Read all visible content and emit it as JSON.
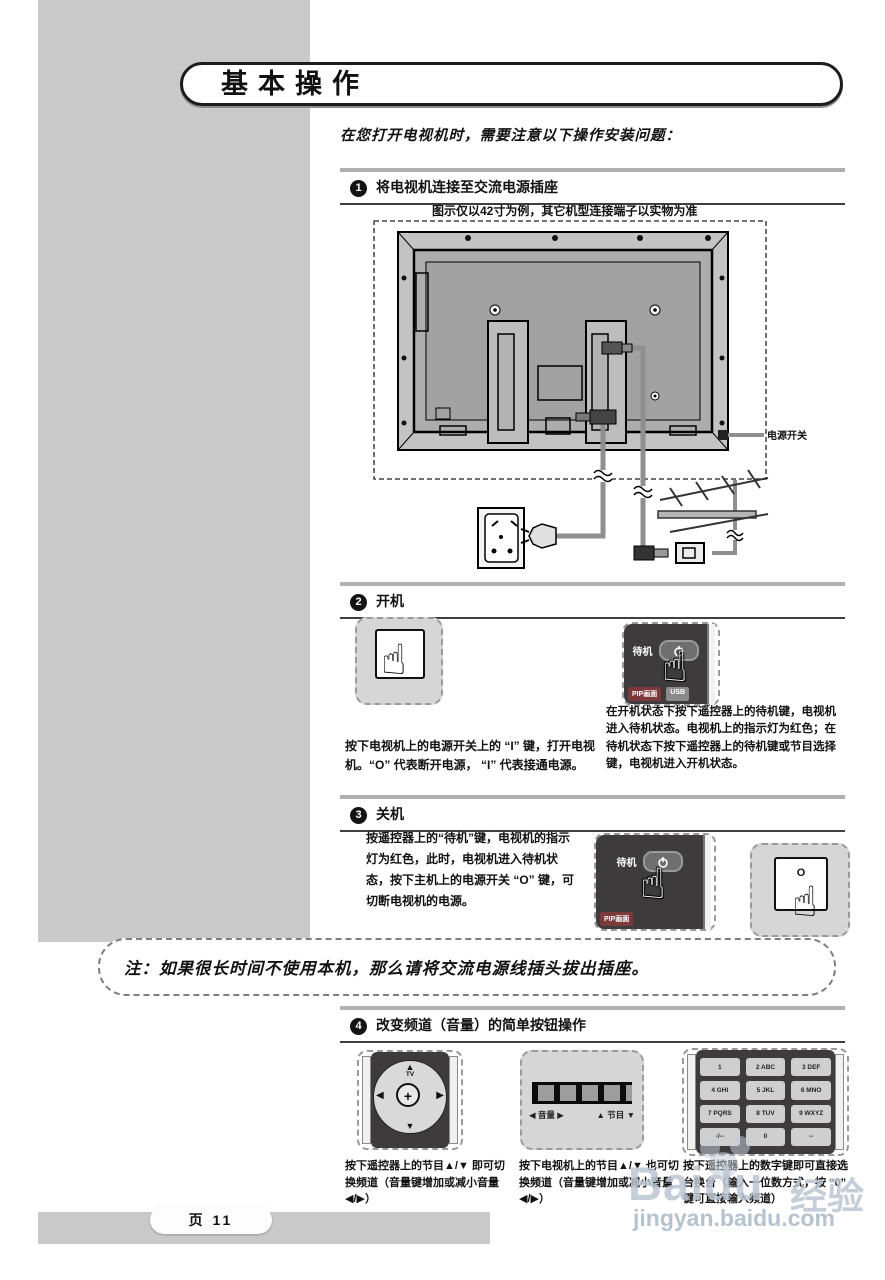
{
  "page": {
    "title": "基本操作",
    "intro": "在您打开电视机时，需要注意以下操作安装问题：",
    "page_label": "页 11"
  },
  "sections": {
    "s1": {
      "num": "1",
      "title": "将电视机连接至交流电源插座",
      "caption": "图示仅以42寸为例，其它机型连接端子以实物为准",
      "power_switch_label": "电源开关"
    },
    "s2": {
      "num": "2",
      "title": "开机",
      "left_text": "按下电视机上的电源开关上的 “I” 键，打开电视机。“O” 代表断开电源， “I” 代表接通电源。",
      "right_text": "在开机状态下按下遥控器上的待机键，电视机进入待机状态。电视机上的指示灯为红色；在待机状态下按下遥控器上的待机键或节目选择键，电视机进入开机状态。",
      "standby_label": "待机",
      "pip_label": "PIP画面",
      "usb_label": "USB"
    },
    "s3": {
      "num": "3",
      "title": "关机",
      "text": "按遥控器上的“待机”键，电视机的指示灯为红色，此时，电视机进入待机状态，按下主机上的电源开关 “O” 键，可切断电视机的电源。",
      "standby_label": "待机",
      "pip_label": "PIP画面",
      "switch_o": "O"
    },
    "note": "注：如果很长时间不使用本机，那么请将交流电源线插头拔出插座。",
    "s4": {
      "num": "4",
      "title": "改变频道（音量）的简单按钮操作",
      "dpad": {
        "top": "▲",
        "top_sub": "TV",
        "bottom": "▼",
        "left": "◀",
        "right": "▶",
        "center": "+"
      },
      "tv_buttons": {
        "vol": "◀ 音量 ▶",
        "prog": "▲ 节目 ▼"
      },
      "keypad": [
        "1",
        "2 ABC",
        "3 DEF",
        "4 GHI",
        "5 JKL",
        "6 MNO",
        "7 PQRS",
        "8 TUV",
        "9 WXYZ",
        "-/--",
        "0",
        "--"
      ],
      "captions": [
        "按下遥控器上的节目▲/▼ 即可切换频道（音量键增加或减小音量◀/▶）",
        "按下电视机上的节目▲/▼ 也可切换频道（音量键增加或减小音量◀/▶）",
        "按下遥控器上的数字键即可直接选台换台（输入一位数方式，按 “0” 键可直接输入频道）"
      ]
    }
  },
  "watermark": {
    "brand": "Baidu",
    "suffix": "经验",
    "url": "jingyan.baidu.com"
  }
}
